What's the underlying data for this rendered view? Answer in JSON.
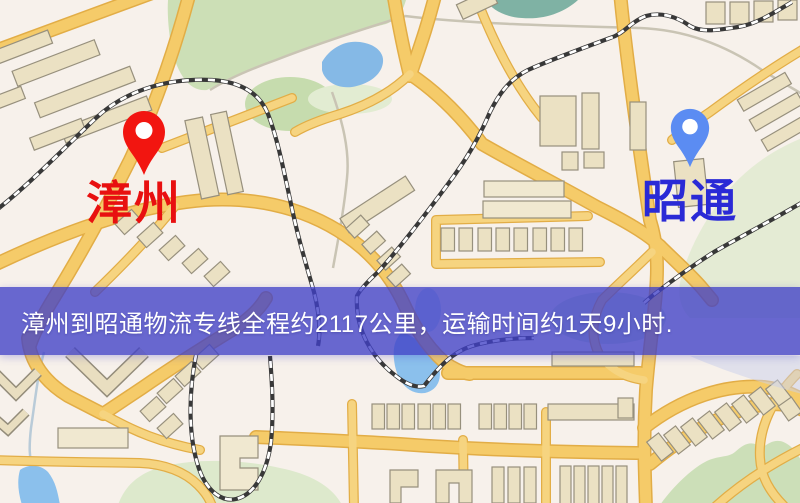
{
  "page": {
    "kind": "logistics-route-map"
  },
  "map": {
    "origin": {
      "name": "漳州",
      "pin_color": "#f21510",
      "label_color": "#e81010"
    },
    "destination": {
      "name": "昭通",
      "pin_color": "#5b8cf2",
      "label_color": "#2a2ad6"
    },
    "banner": {
      "text": "漳州到昭通物流专线全程约2117公里，运输时间约1天9小时.",
      "distance": "2117公里",
      "duration": "1天9小时",
      "bg_color": "#4242c8",
      "text_color": "#ffffff"
    }
  }
}
